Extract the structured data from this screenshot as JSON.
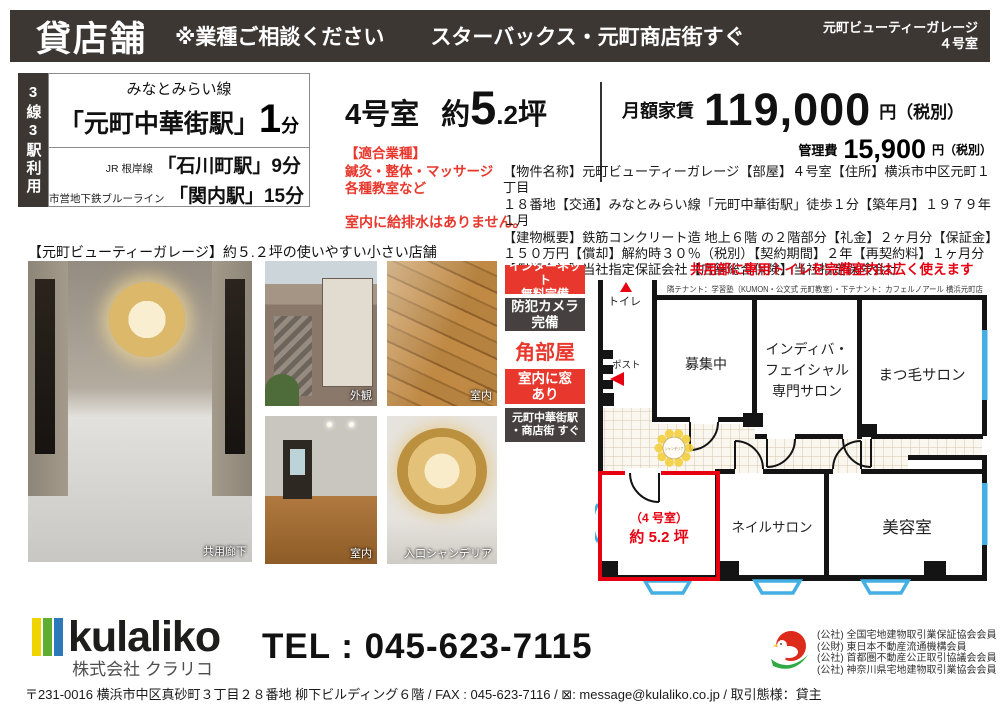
{
  "header": {
    "title": "貸店舗",
    "note": "※業種ご相談ください",
    "subtitle": "スターバックス・元町商店街すぐ",
    "building_line1": "元町ビューティーガレージ",
    "building_line2": "４号室"
  },
  "access": {
    "rail_label": "3線3駅利用",
    "main_line": "みなとみらい線",
    "main_station": "「元町中華街駅」",
    "main_minutes": "1",
    "main_min_suffix": "分",
    "sub1_line": "JR 根岸線",
    "sub1_station": "「石川町駅」9分",
    "sub2_line": "市営地下鉄ブルーライン",
    "sub2_station": "「関内駅」15分"
  },
  "unit": {
    "room": "4号室",
    "size_prefix": "約",
    "size_big": "5",
    "size_dot": ".2",
    "size_unit": "坪",
    "industries": "【適合業種】\n鍼灸・整体・マッサージ\n各種教室など",
    "warning": "室内に給排水はありません。"
  },
  "rent": {
    "label": "月額家賃",
    "amount": "119,000",
    "unit": "円（税別）",
    "mgmt_label": "管理費",
    "mgmt_amount": "15,900",
    "mgmt_unit": "円（税別）"
  },
  "details": {
    "lines": [
      "【物件名称】元町ビューティーガレージ【部屋】４号室【住所】横浜市中区元町１丁目",
      "１８番地【交通】みなとみらい線「元町中華街駅」徒歩１分【築年月】１９７９年１月",
      "【建物概要】鉄筋コンクリート造 地上６階 の２階部分【礼金】２ヶ月分【保証金】",
      "１５０万円【償却】解約時３０％（税別）【契約期間】２年【再契約料】１ヶ月分",
      "【保証会社】当社指定保証会社【店舗総合保険】当社指定保険会社"
    ]
  },
  "photos": {
    "section_title": "【元町ビューティーガレージ】約５.２坪の使いやすい小さい店舗",
    "caption_large": "共用廊下",
    "caption_top1": "外観",
    "caption_top2": "室内",
    "caption_bottom1": "室内",
    "caption_bottom2": "入口シャンデリア"
  },
  "badges": {
    "internet": "インターネット\n無料完備",
    "camera": "防犯カメラ\n完備",
    "corner": "角部屋",
    "window": "室内に窓\nあり",
    "station": "元町中華街駅\n・商店街 すぐ"
  },
  "floorplan": {
    "heading": "共用部に専用トイレを完備室内は広く使えます",
    "tenant_note": "隣テナント：学習塾（KUMON・公文式 元町教室）・下テナント：カフェルノアール 横浜元町店",
    "labels": {
      "toilet": "トイレ",
      "post": "ポスト",
      "vacant": "募集中",
      "indiba1": "インディバ・",
      "indiba2": "フェイシャル",
      "indiba3": "専門サロン",
      "matsuge": "まつ毛サロン",
      "unit1": "（4 号室）",
      "unit2": "約 5.2 坪",
      "nail": "ネイルサロン",
      "beauty": "美容室",
      "chandelier": "シャンデリア"
    }
  },
  "footer": {
    "logo_text": "kulaliko",
    "company": "株式会社 クラリコ",
    "tel": "TEL : 045-623-7115",
    "memberships": [
      "(公社) 全国宅地建物取引業保証協会会員",
      "(公財) 東日本不動産流通機構会員",
      "(公社) 首都圏不動産公正取引協議会会員",
      "(公社) 神奈川県宅地建物取引業協会会員"
    ],
    "address": "〒231-0016 横浜市中区真砂町３丁目２８番地 柳下ビルディング６階 / FAX : 045-623-7116 / ⊠: message@kulaliko.co.jp / 取引態様：貸主"
  },
  "colors": {
    "accent_red": "#e8382d",
    "plan_red": "#e60012",
    "dark": "#3d3734",
    "window_blue": "#44afe3"
  }
}
